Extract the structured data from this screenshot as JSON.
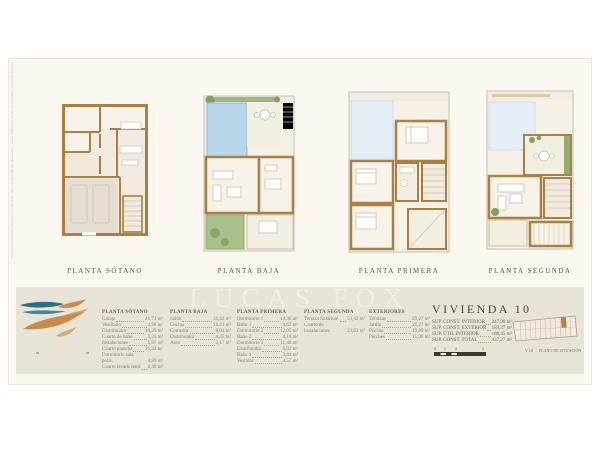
{
  "watermark": "LUCAS FOX",
  "disclaimer": "Este plano es meramente orientativo. Las superficies, cotas y distribuciones son aproximadas y pueden sufrir modificaciones por necesidades tecnicas del proyecto.",
  "plans": [
    {
      "caption": "PLANTA SÓTANO"
    },
    {
      "caption": "PLANTA BAJA"
    },
    {
      "caption": "PLANTA PRIMERA"
    },
    {
      "caption": "PLANTA SEGUNDA"
    }
  ],
  "schedules": [
    {
      "title": "PLANTA SÓTANO",
      "rows": [
        {
          "name": "Garaje",
          "value": "41,74 m²"
        },
        {
          "name": "Vestíbulo",
          "value": "4,98 m²"
        },
        {
          "name": "Distribuidor",
          "value": "10,29 m²"
        },
        {
          "name": "Cuarto de baño",
          "value": "5,23 m²"
        },
        {
          "name": "Instalaciones",
          "value": "5,87 m²"
        },
        {
          "name": "Cuarto plancha",
          "value": "21,34 m²"
        },
        {
          "name": "Dormitorio sala poliv.",
          "value": "4,89 m²"
        },
        {
          "name": "Cuarto lavado tend.",
          "value": "6,40 m²"
        }
      ]
    },
    {
      "title": "PLANTA BAJA",
      "rows": [
        {
          "name": "Salón",
          "value": "31,42 m²"
        },
        {
          "name": "Cocina",
          "value": "16,21 m²"
        },
        {
          "name": "Comedor",
          "value": "8,04 m²"
        },
        {
          "name": "Distribuidor",
          "value": "4,25 m²"
        },
        {
          "name": "Aseo",
          "value": "3,17 m²"
        }
      ]
    },
    {
      "title": "PLANTA PRIMERA",
      "rows": [
        {
          "name": "Dormitorio 1",
          "value": "14,36 m²"
        },
        {
          "name": "Baño 1",
          "value": "4,62 m²"
        },
        {
          "name": "Dormitorio 2",
          "value": "12,05 m²"
        },
        {
          "name": "Baño 2",
          "value": "4,10 m²"
        },
        {
          "name": "Dormitorio 3",
          "value": "11,48 m²"
        },
        {
          "name": "Distribuidor",
          "value": "6,92 m²"
        },
        {
          "name": "Baño 3",
          "value": "3,84 m²"
        },
        {
          "name": "Vestidor",
          "value": "4,57 m²"
        }
      ]
    },
    {
      "title": "PLANTA SEGUNDA",
      "rows": [
        {
          "name": "Terraza Solárium",
          "value": "53,42 m²"
        },
        {
          "name": "Cuarto de instalaciones",
          "value": "23,83 m²"
        }
      ]
    },
    {
      "title": "EXTERIORES",
      "rows": [
        {
          "name": "Terrazas",
          "value": "29,27 m²"
        },
        {
          "name": "Jardín",
          "value": "21,27 m²"
        },
        {
          "name": "Piscina",
          "value": "19,80 m²"
        },
        {
          "name": "Porches",
          "value": "15,06 m²"
        }
      ]
    }
  ],
  "summary": {
    "title": "VIVIENDA 10",
    "rows": [
      {
        "name": "SUP. CONST. INTERIOR",
        "value": "247,90 m²"
      },
      {
        "name": "SUP. CONST. EXTERIOR",
        "value": "189,37 m²"
      },
      {
        "name": "SUP. ÚTIL INTERIOR",
        "value": "186,45 m²"
      },
      {
        "name": "SUP. CONST. TOTAL",
        "value": "437,27 m²"
      }
    ],
    "scale_labels": [
      "0",
      "1",
      "2",
      "5"
    ]
  },
  "siteplan": {
    "unit_label": "V 10",
    "caption": "PLANO DE SITUACIÓN"
  },
  "colors": {
    "sheet": "#faf7f0",
    "band": "#e7e3d7",
    "wall": "#a97f44",
    "pool": "#b7d7e8",
    "void": "#e3eef6",
    "green": "#7da05c",
    "accent_logo_teal": "#2e6e80",
    "accent_logo_orange": "#c88c4a"
  }
}
